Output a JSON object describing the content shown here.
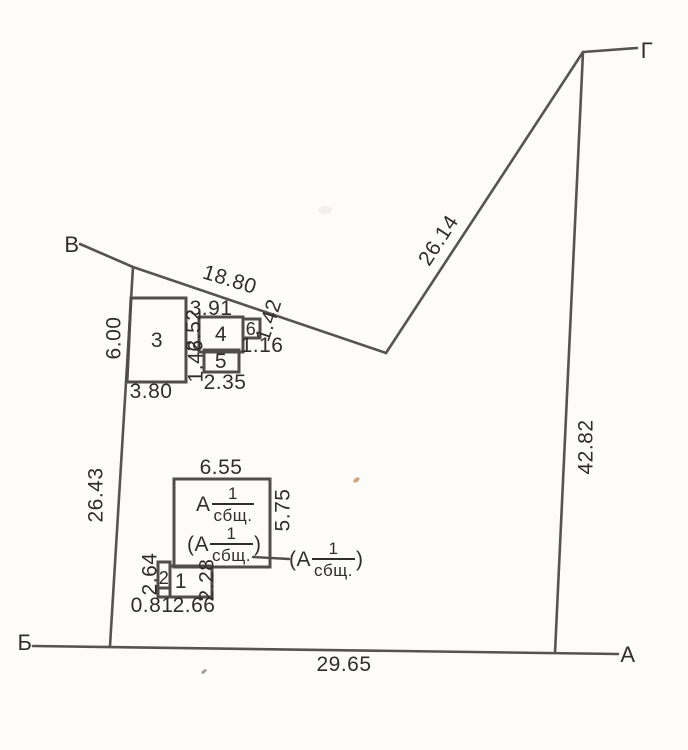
{
  "corners": {
    "v": "В",
    "g": "Г",
    "b": "Б",
    "a": "А"
  },
  "boundary_dimensions": {
    "upper_left": "18.80",
    "upper_right": "26.14",
    "right": "42.82",
    "bottom": "29.65",
    "left_upper": "6.00",
    "left_lower": "26.43"
  },
  "buildings": {
    "b3": {
      "number": "3",
      "bottom": "3.80"
    },
    "b4": {
      "number": "4",
      "top": "3.91",
      "left": "2.52"
    },
    "b5": {
      "number": "5",
      "left": "1.46",
      "bottom": "2.35"
    },
    "b6": {
      "number": "6",
      "side": "1.42",
      "bottom": "1.16"
    },
    "main": {
      "top": "6.55",
      "right": "5.75"
    },
    "annex1": {
      "number": "1",
      "right": "2.28",
      "bottom": "2.66"
    },
    "annex2": {
      "number": "2",
      "left": "2.64",
      "bottom": "0.81"
    }
  },
  "apartment_labels": {
    "inside_top": {
      "prefix": "А",
      "num": "1",
      "den": "сбщ."
    },
    "inside_bottom": {
      "prefix": "(А",
      "num": "1",
      "den": "сбщ.",
      "suffix": ")"
    },
    "outside": {
      "prefix": "(А",
      "num": "1",
      "den": "сбщ.",
      "suffix": ")"
    }
  },
  "colors": {
    "paper": "#fdfcfa",
    "ink": "#2e2e2e",
    "line": "#545454",
    "speck": "#c9905f"
  }
}
